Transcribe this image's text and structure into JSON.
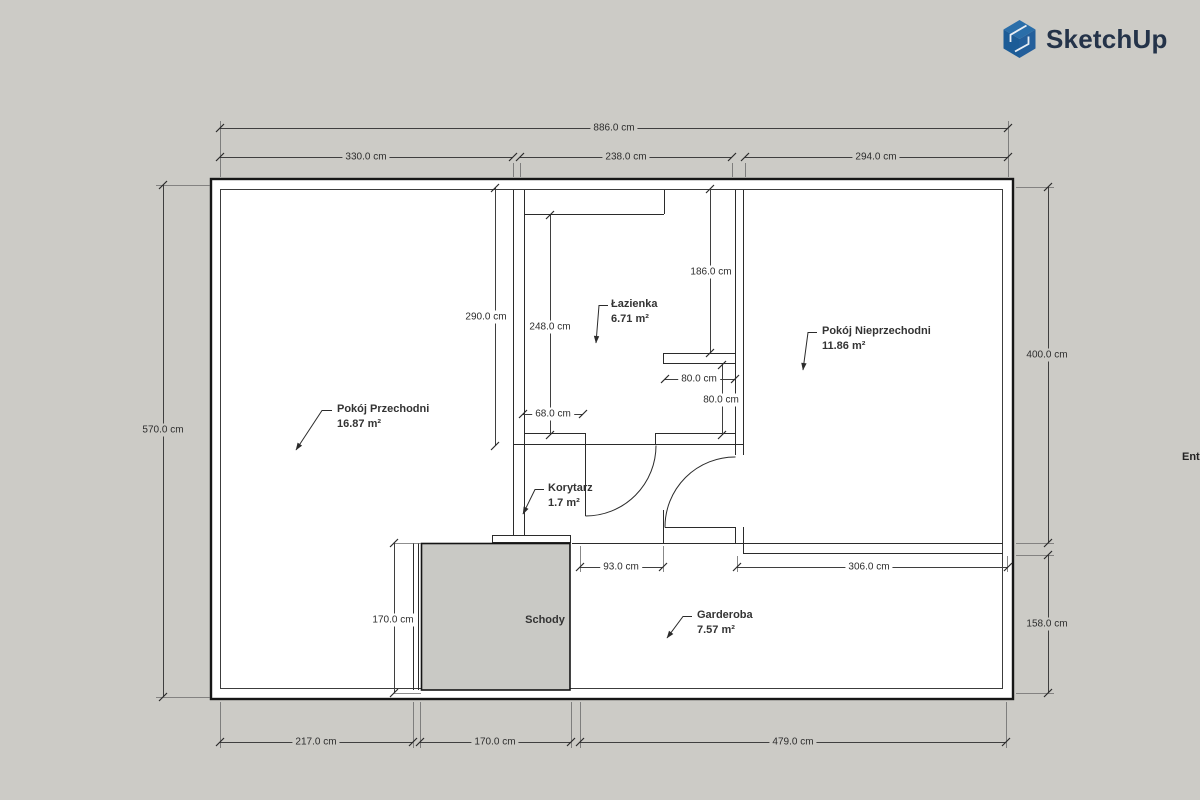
{
  "brand": {
    "name": "SketchUp"
  },
  "edge_text": "Ent",
  "colors": {
    "canvas_bg": "#cccbc6",
    "plan_bg": "#ffffff",
    "wall": "#1a1a1a",
    "dimension_line": "#3f3f3f",
    "stairs_fill": "#c9c9c5",
    "brand_blue": "#2268a6",
    "brand_blue_dark": "#174f84",
    "brand_navy": "#243349"
  },
  "rooms": {
    "przechodni": {
      "name": "Pokój Przechodni",
      "area": "16.87 m²"
    },
    "lazienka": {
      "name": "Łazienka",
      "area": "6.71 m²"
    },
    "nieprzechodni": {
      "name": "Pokój Nieprzechodni",
      "area": "11.86 m²"
    },
    "korytarz": {
      "name": "Korytarz",
      "area": "1.7 m²"
    },
    "garderoba": {
      "name": "Garderoba",
      "area": "7.57 m²"
    },
    "schody": {
      "name": "Schody"
    }
  },
  "dimensions": {
    "top": {
      "total": "886.0 cm",
      "seg1": "330.0 cm",
      "seg2": "238.0 cm",
      "seg3": "294.0 cm"
    },
    "left": {
      "total": "570.0 cm"
    },
    "right": {
      "upper": "400.0 cm",
      "lower": "158.0 cm"
    },
    "bottom": {
      "seg1": "217.0 cm",
      "seg2": "170.0 cm",
      "seg3": "479.0 cm"
    },
    "interior": {
      "bathroom_height": "290.0 cm",
      "bathroom_inner_height": "248.0 cm",
      "bathroom_right_height": "186.0 cm",
      "niche_width": "80.0 cm",
      "niche_height": "80.0 cm",
      "bathroom_bottom_wall": "68.0 cm",
      "corridor_passage": "93.0 cm",
      "garderoba_width": "306.0 cm",
      "stairs_height": "170.0 cm"
    }
  }
}
